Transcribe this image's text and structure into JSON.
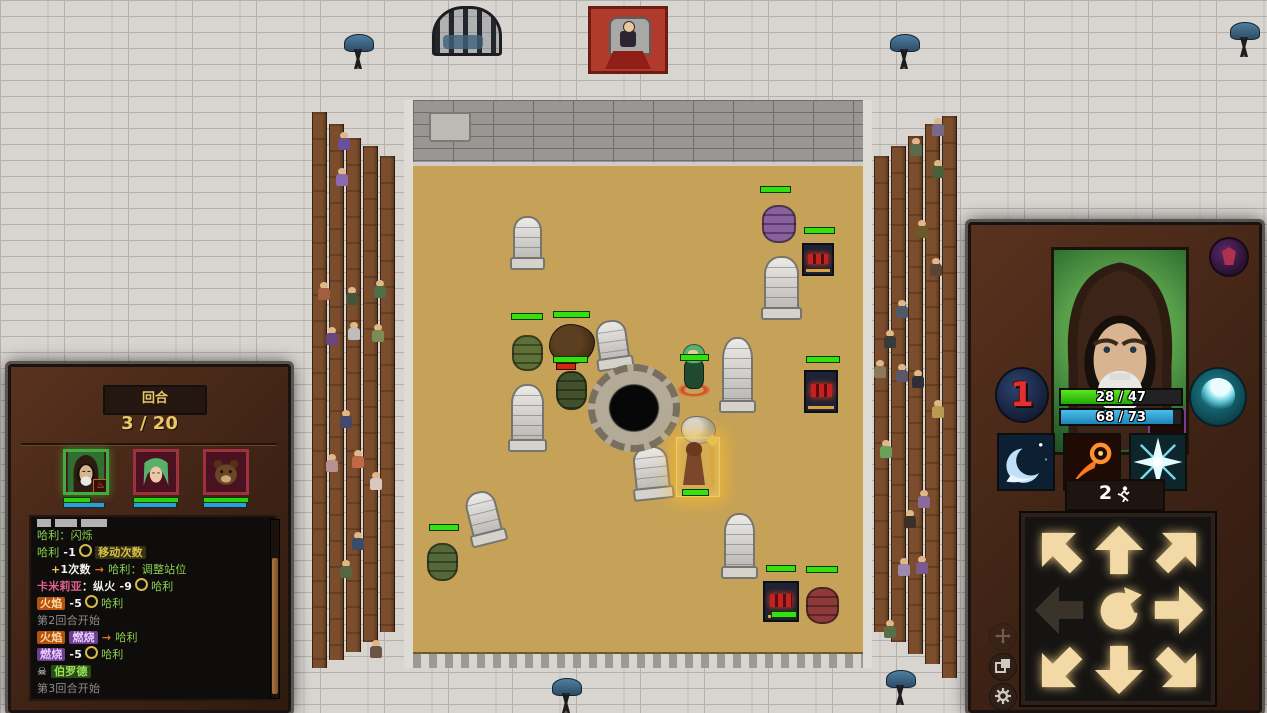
{
  "colors": {
    "hp_green": "#2ecf10",
    "mp_blue": "#2e9fd6",
    "gold": "#e9c766",
    "sand": "#c5a258",
    "wood": "#5e3a20",
    "log_bg": "#0e0d0c"
  },
  "hud": {
    "left": {
      "turn_label": "回合",
      "turn_value": "3 / 20",
      "party": [
        {
          "portrait": "hooded-mage",
          "border": "green",
          "hp_pct": 60,
          "mp_pct": 92,
          "status": "burning"
        },
        {
          "portrait": "green-haired-elf",
          "border": "red",
          "hp_pct": 100,
          "mp_pct": 95
        },
        {
          "portrait": "bear",
          "border": "red",
          "hp_pct": 100,
          "mp_pct": 95
        }
      ],
      "log": [
        {
          "clipped": true,
          "segments": []
        },
        {
          "segments": [
            {
              "t": "哈利：闪烁",
              "c": "green"
            }
          ]
        },
        {
          "segments": [
            {
              "t": "哈利",
              "c": "green"
            },
            {
              "t": " -1",
              "c": "num"
            },
            {
              "icon": "coin"
            },
            {
              "t": "移动次数",
              "c": "badge-olive"
            }
          ]
        },
        {
          "indent": true,
          "segments": [
            {
              "t": "+",
              "c": "gold"
            },
            {
              "t": "1次数",
              "c": "num"
            },
            {
              "t": " → ",
              "c": "arrow"
            },
            {
              "t": "哈利：调整站位",
              "c": "green"
            }
          ]
        },
        {
          "segments": [
            {
              "t": "卡米莉亚",
              "c": "pink"
            },
            {
              "t": "：纵火",
              "c": "num"
            },
            {
              "t": " -9",
              "c": "num"
            },
            {
              "icon": "coin"
            },
            {
              "t": "哈利",
              "c": "green"
            }
          ]
        },
        {
          "segments": [
            {
              "t": "火焰",
              "c": "badge-orange"
            },
            {
              "t": " -5",
              "c": "num"
            },
            {
              "icon": "coin"
            },
            {
              "t": "哈利",
              "c": "green"
            }
          ]
        },
        {
          "segments": [
            {
              "t": "第2回合开始",
              "c": "gray"
            }
          ]
        },
        {
          "segments": [
            {
              "t": "火焰",
              "c": "badge-orange"
            },
            {
              "t": " ",
              "c": "num"
            },
            {
              "t": "燃烧",
              "c": "badge-purple"
            },
            {
              "t": " → ",
              "c": "arrow"
            },
            {
              "t": "哈利",
              "c": "green"
            }
          ]
        },
        {
          "segments": [
            {
              "t": "燃烧",
              "c": "badge-purple"
            },
            {
              "t": " -5",
              "c": "num"
            },
            {
              "icon": "coin"
            },
            {
              "t": "哈利",
              "c": "green"
            }
          ]
        },
        {
          "segments": [
            {
              "icon": "skull",
              "t": "☠ "
            },
            {
              "t": "伯罗德",
              "c": "badge-green"
            }
          ]
        },
        {
          "segments": [
            {
              "t": "第3回合开始",
              "c": "gray"
            }
          ]
        }
      ]
    },
    "right": {
      "portrait": "hooded-mage",
      "status_icon": "burning-flame",
      "faction_badge": "purple-crest",
      "turn_order": "1",
      "hp_text": "28 / 47",
      "mp_text": "68 / 73",
      "swirl_icon": "water-swirl",
      "abilities": [
        {
          "name": "wave"
        },
        {
          "name": "fireball"
        },
        {
          "name": "frost-star"
        }
      ],
      "move_points": "2",
      "dpad": [
        {
          "dir": "nw",
          "state": "lit"
        },
        {
          "dir": "n",
          "state": "lit"
        },
        {
          "dir": "ne",
          "state": "lit"
        },
        {
          "dir": "w",
          "state": "dim"
        },
        {
          "dir": "center",
          "state": "rotate"
        },
        {
          "dir": "e",
          "state": "lit"
        },
        {
          "dir": "sw",
          "state": "lit"
        },
        {
          "dir": "s",
          "state": "lit"
        },
        {
          "dir": "se",
          "state": "lit"
        }
      ],
      "mini_buttons": [
        {
          "name": "move-cross",
          "dim": true
        },
        {
          "name": "layers",
          "dim": false
        },
        {
          "name": "gear",
          "dim": false
        }
      ]
    }
  },
  "world": {
    "throne": {
      "x": 588,
      "y": 6
    },
    "cage": {
      "x": 432,
      "y": 6
    },
    "grills": [
      {
        "x": 344,
        "y": 34
      },
      {
        "x": 890,
        "y": 34
      },
      {
        "x": 1230,
        "y": 22
      },
      {
        "x": 886,
        "y": 670
      },
      {
        "x": 552,
        "y": 678
      }
    ],
    "stands": {
      "left": {
        "x": 312,
        "y": 112,
        "h": 560,
        "plank_tops": [
          0,
          12,
          26,
          34,
          44
        ],
        "plank_bottoms": [
          556,
          548,
          540,
          530,
          520
        ]
      },
      "right": {
        "x": 874,
        "y": 112,
        "h": 566,
        "plank_tops": [
          44,
          34,
          24,
          12,
          4
        ],
        "plank_bottoms": [
          520,
          530,
          542,
          552,
          566
        ]
      }
    },
    "spectators_left": [
      {
        "x": 26,
        "y": 20,
        "b": "#6a4f9a"
      },
      {
        "x": 24,
        "y": 56,
        "b": "#8a6ab0"
      },
      {
        "x": 6,
        "y": 170,
        "b": "#a06040"
      },
      {
        "x": 34,
        "y": 175,
        "b": "#46543a"
      },
      {
        "x": 62,
        "y": 168,
        "b": "#4f6e45"
      },
      {
        "x": 14,
        "y": 215,
        "b": "#6a4580"
      },
      {
        "x": 36,
        "y": 210,
        "b": "#bdbdbd"
      },
      {
        "x": 60,
        "y": 212,
        "b": "#7d8c54"
      },
      {
        "x": 28,
        "y": 298,
        "b": "#44486a"
      },
      {
        "x": 14,
        "y": 342,
        "b": "#b89090"
      },
      {
        "x": 40,
        "y": 338,
        "b": "#c06a45"
      },
      {
        "x": 58,
        "y": 360,
        "b": "#d8c8c0"
      },
      {
        "x": 40,
        "y": 420,
        "b": "#3c4c68"
      },
      {
        "x": 28,
        "y": 448,
        "b": "#56663f"
      },
      {
        "x": 58,
        "y": 528,
        "b": "#6a5545"
      }
    ],
    "spectators_right": [
      {
        "x": 58,
        "y": 6,
        "b": "#7a6a8a"
      },
      {
        "x": 36,
        "y": 26,
        "b": "#5a6a4a"
      },
      {
        "x": 58,
        "y": 48,
        "b": "#4a5e3a"
      },
      {
        "x": 42,
        "y": 108,
        "b": "#6a5a2a"
      },
      {
        "x": 56,
        "y": 146,
        "b": "#5a4436"
      },
      {
        "x": 22,
        "y": 188,
        "b": "#4e5a66"
      },
      {
        "x": 10,
        "y": 218,
        "b": "#3a3a3a"
      },
      {
        "x": 0,
        "y": 248,
        "b": "#8a7a5a"
      },
      {
        "x": 22,
        "y": 252,
        "b": "#585868"
      },
      {
        "x": 38,
        "y": 258,
        "b": "#2e2e38"
      },
      {
        "x": 58,
        "y": 288,
        "b": "#b89a50"
      },
      {
        "x": 6,
        "y": 328,
        "b": "#6aa05a"
      },
      {
        "x": 44,
        "y": 378,
        "b": "#8a6a9a"
      },
      {
        "x": 30,
        "y": 398,
        "b": "#3a3028"
      },
      {
        "x": 24,
        "y": 446,
        "b": "#9a8ab0"
      },
      {
        "x": 42,
        "y": 444,
        "b": "#7a5a8a"
      },
      {
        "x": 10,
        "y": 508,
        "b": "#5a6e45"
      }
    ],
    "arena": {
      "pit": {
        "x": 588,
        "y": 364,
        "w": 92,
        "h": 88
      },
      "trapdoor": {
        "x": 420,
        "y": 112
      },
      "gravestones": [
        {
          "x": 513,
          "y": 216,
          "w": 29,
          "h": 50,
          "r": 0
        },
        {
          "x": 511,
          "y": 384,
          "w": 33,
          "h": 64,
          "r": 0
        },
        {
          "x": 597,
          "y": 320,
          "w": 31,
          "h": 46,
          "r": -8
        },
        {
          "x": 722,
          "y": 337,
          "w": 31,
          "h": 72,
          "r": 0
        },
        {
          "x": 764,
          "y": 256,
          "w": 35,
          "h": 60,
          "r": 0
        },
        {
          "x": 634,
          "y": 446,
          "w": 35,
          "h": 50,
          "r": -6
        },
        {
          "x": 468,
          "y": 491,
          "w": 31,
          "h": 50,
          "r": -14
        },
        {
          "x": 724,
          "y": 513,
          "w": 31,
          "h": 62,
          "r": 0
        }
      ],
      "barrels": [
        {
          "x": 512,
          "y": 335,
          "w": 31,
          "h": 36,
          "color": "green"
        },
        {
          "x": 556,
          "y": 371,
          "w": 31,
          "h": 39,
          "color": "darkgreen"
        },
        {
          "x": 427,
          "y": 543,
          "w": 31,
          "h": 38,
          "color": "green2"
        },
        {
          "x": 762,
          "y": 205,
          "w": 34,
          "h": 38,
          "color": "purple"
        },
        {
          "x": 806,
          "y": 587,
          "w": 33,
          "h": 37,
          "color": "red"
        }
      ],
      "braziers": [
        {
          "x": 802,
          "y": 243,
          "w": 32,
          "h": 33
        },
        {
          "x": 804,
          "y": 370,
          "w": 34,
          "h": 43
        },
        {
          "x": 763,
          "y": 581,
          "w": 36,
          "h": 41
        }
      ],
      "fires": [
        {
          "x": 713,
          "y": 287,
          "w": 34,
          "h": 43
        },
        {
          "x": 762,
          "y": 333,
          "w": 37,
          "h": 39
        },
        {
          "x": 757,
          "y": 378,
          "w": 39,
          "h": 41
        }
      ],
      "hp_bars": [
        {
          "x": 760,
          "y": 186,
          "w": 31
        },
        {
          "x": 804,
          "y": 227,
          "w": 31
        },
        {
          "x": 511,
          "y": 313,
          "w": 32
        },
        {
          "x": 553,
          "y": 311,
          "w": 37
        },
        {
          "x": 553,
          "y": 356,
          "w": 35
        },
        {
          "x": 556,
          "y": 363,
          "w": 20,
          "red": true
        },
        {
          "x": 680,
          "y": 354,
          "w": 29
        },
        {
          "x": 806,
          "y": 356,
          "w": 34
        },
        {
          "x": 682,
          "y": 489,
          "w": 27
        },
        {
          "x": 429,
          "y": 524,
          "w": 30
        },
        {
          "x": 766,
          "y": 565,
          "w": 30
        },
        {
          "x": 806,
          "y": 566,
          "w": 32
        },
        {
          "x": 771,
          "y": 611,
          "w": 26
        }
      ],
      "stonepile": {
        "x": 681,
        "y": 416,
        "w": 33,
        "h": 26
      },
      "bear": {
        "x": 549,
        "y": 324,
        "w": 44,
        "h": 38
      },
      "elf": {
        "x": 679,
        "y": 344,
        "w": 30,
        "h": 56
      },
      "hero": {
        "x": 676,
        "y": 437,
        "w": 42,
        "h": 58
      }
    }
  }
}
